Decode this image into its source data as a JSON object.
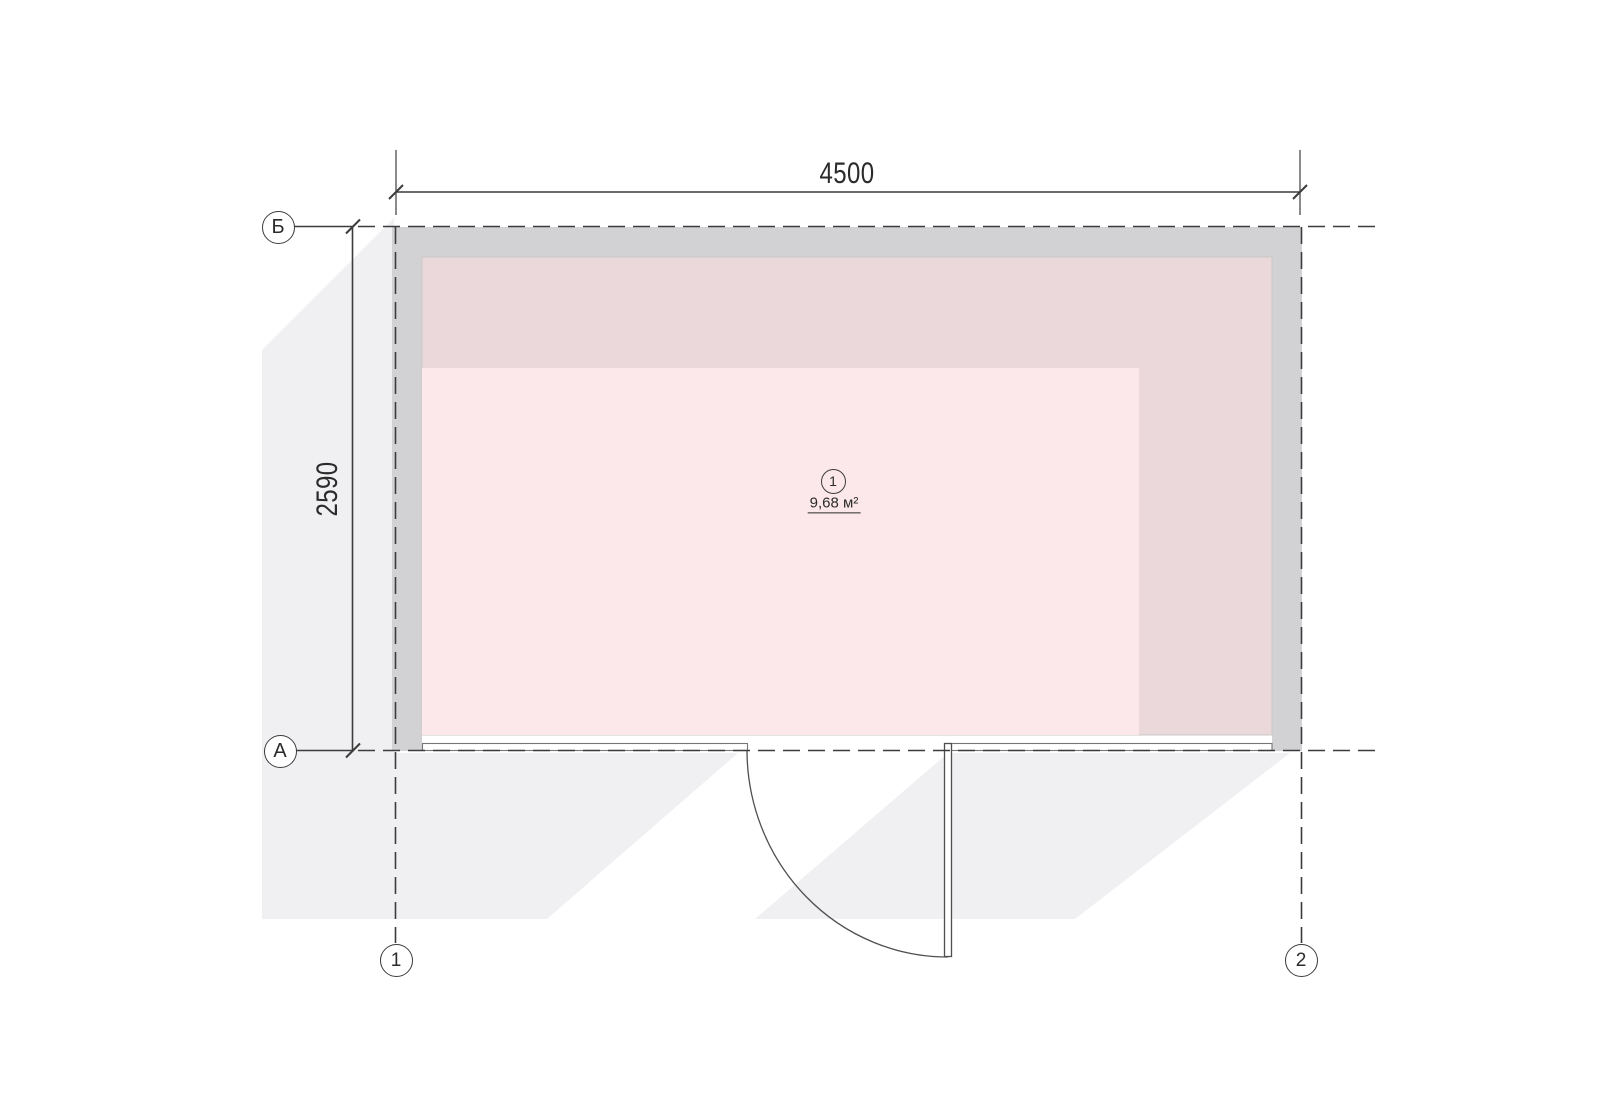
{
  "plan": {
    "room": {
      "number": "1",
      "area": "9,68 м²"
    },
    "dimensions": {
      "width": "4500",
      "height": "2590"
    },
    "axes": {
      "top": "Б",
      "bottom": "А",
      "left": "1",
      "right": "2"
    }
  },
  "colors": {
    "wall": "#d2d1d3",
    "floor_shaded": "#ead8db",
    "floor_light": "#fce8ea",
    "shadow": "#f0eff1",
    "line": "#3c3c3c",
    "door_line": "#4f4f4f"
  }
}
